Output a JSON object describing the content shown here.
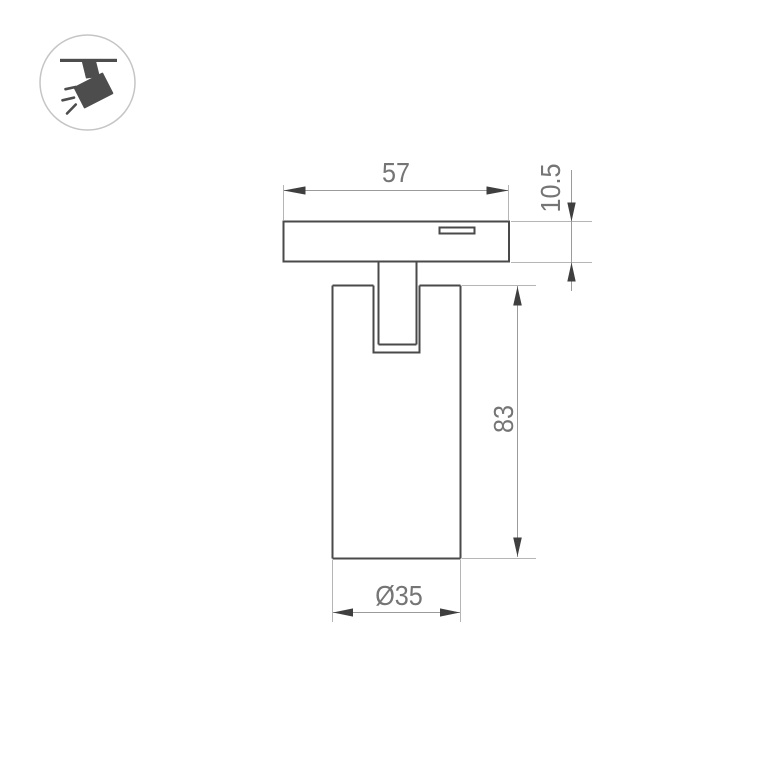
{
  "page": {
    "background_color": "#ffffff"
  },
  "badge": {
    "icon": "track-spotlight-icon",
    "circle_border_color": "#c5c5c5",
    "glyph_color": "#4d4d4d"
  },
  "drawing": {
    "type": "technical-dimension-drawing",
    "object_line_color": "#4a4a4a",
    "dimension_line_color": "#9b9b9b",
    "extension_line_color": "#b5b5b5",
    "arrow_color": "#3f3f3f",
    "text_color": "#757575",
    "dimensions": {
      "base_width": "57",
      "base_height": "10.5",
      "body_height": "83",
      "body_diameter": "Ø35"
    }
  }
}
